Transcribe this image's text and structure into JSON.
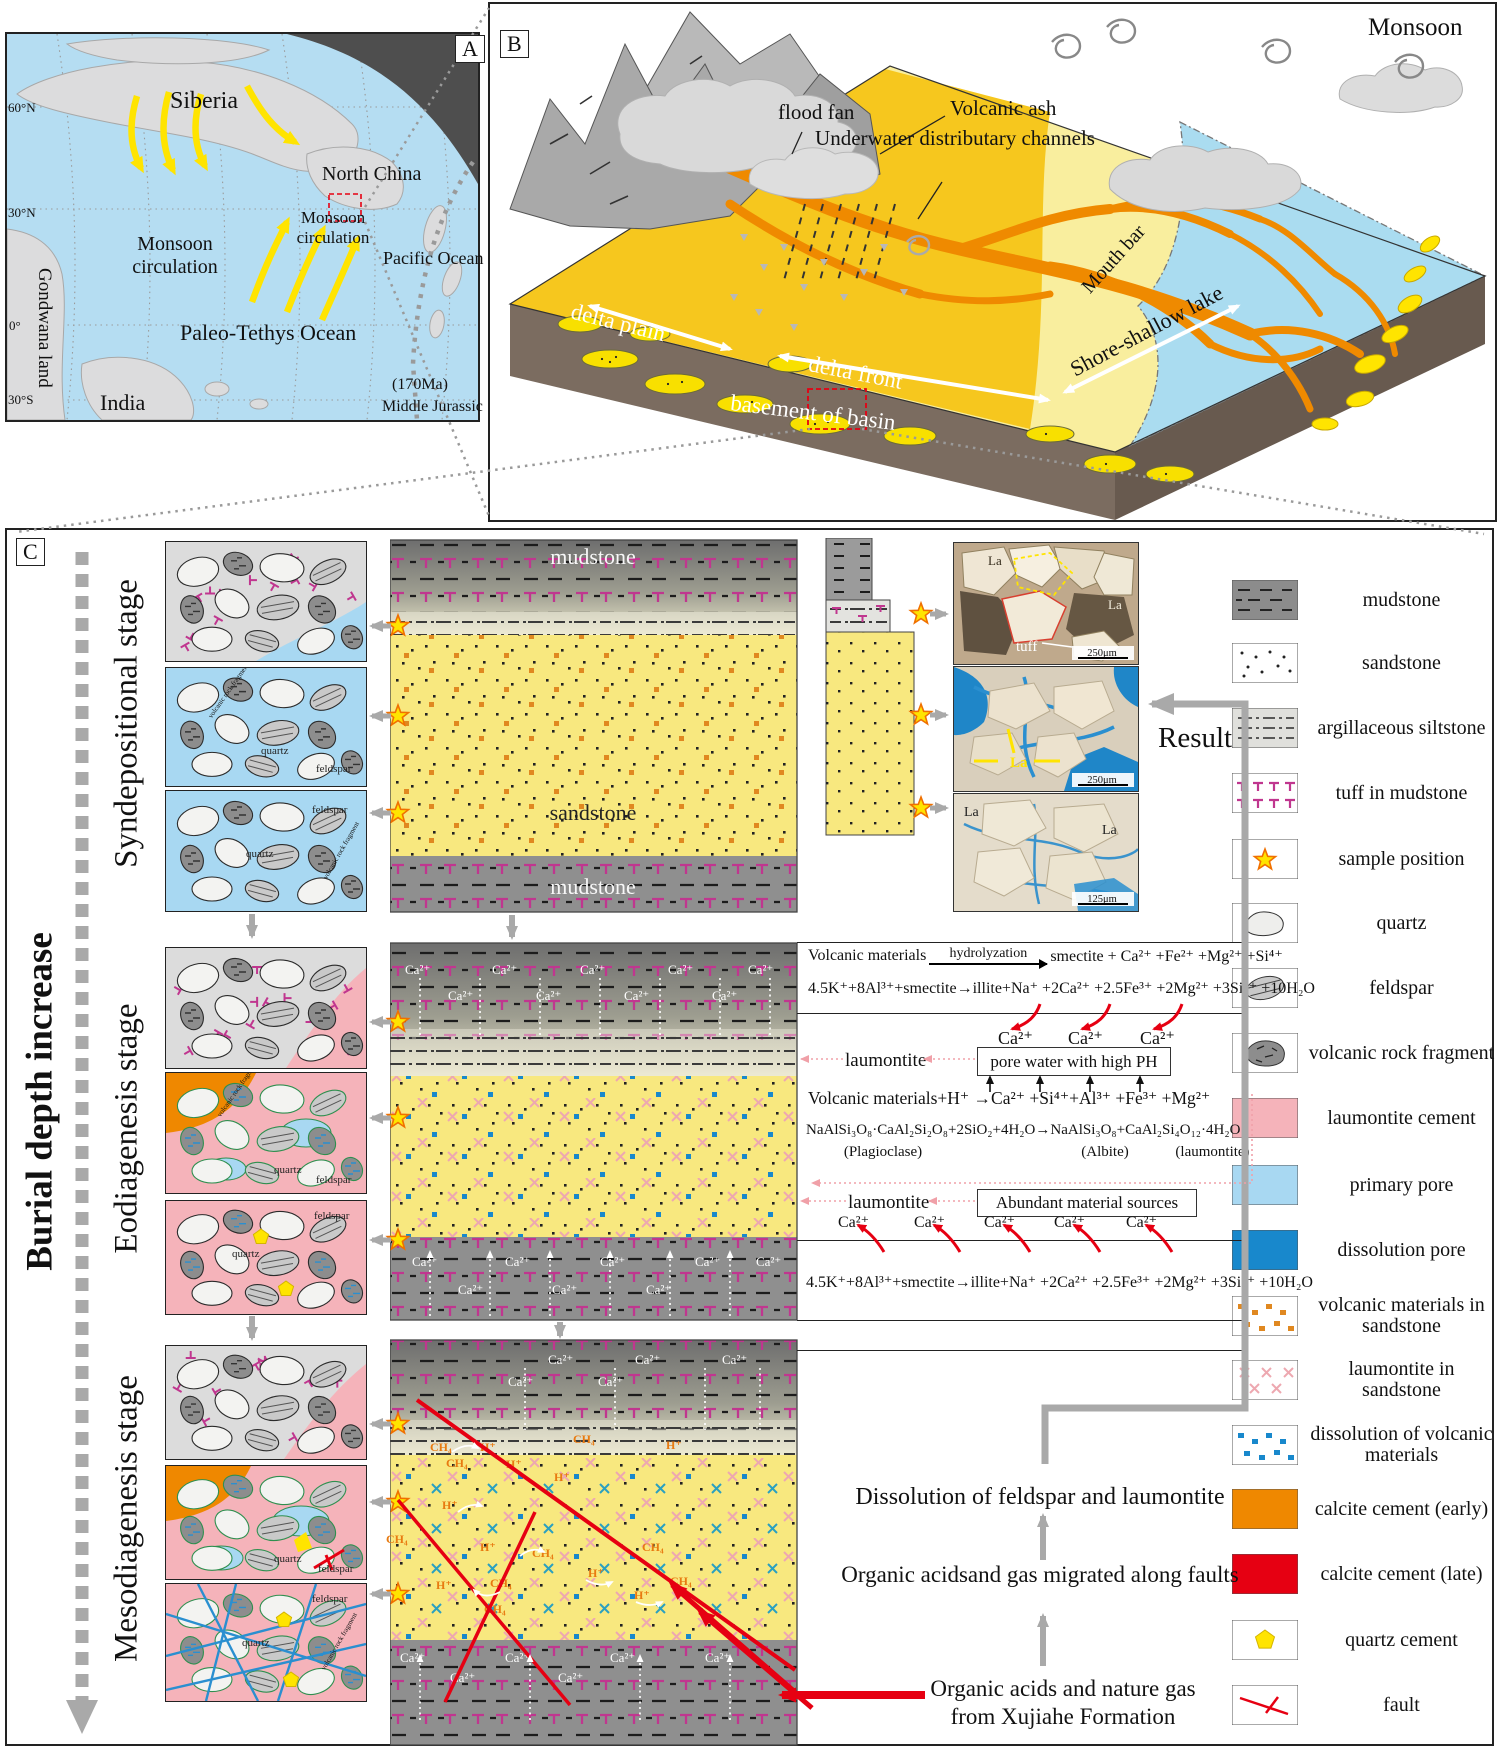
{
  "panel_a": {
    "tag": "A",
    "siberia": "Siberia",
    "north_china": "North China",
    "monsoon_west": "Monsoon circulation",
    "monsoon_east": "Monsoon circulation",
    "pacific": "Pacific Ocean",
    "paleo_tethys": "Paleo-Tethys Ocean",
    "gondwana": "Gondwana land",
    "india": "India",
    "lat_60n": "60°N",
    "lat_30n": "30°N",
    "lat_0": "0°",
    "lat_30s": "30°S",
    "age": "(170Ma)",
    "period": "Middle Jurassic"
  },
  "panel_b": {
    "tag": "B",
    "monsoon": "Monsoon",
    "flood_fan": "flood fan",
    "volcanic_ash": "Volcanic ash",
    "channels": "Underwater distributary channels",
    "mouth_bar": "Mouth bar",
    "shore_lake": "Shore-shallow lake",
    "delta_plain": "delta plain",
    "delta_front": "delta front",
    "basement": "basement of basin"
  },
  "panel_c": {
    "tag": "C",
    "burial_axis": "Burial depth increase",
    "stage_syn": "Syndepositional stage",
    "stage_eo": "Eodiagenesis stage",
    "stage_meso": "Mesodiagenesis stage",
    "mudstone_top": "mudstone",
    "sandstone": "sandstone",
    "mudstone_bottom": "mudstone",
    "grain_quartz": "quartz",
    "grain_feldspar": "feldspar",
    "grain_vrf": "volcanic rock fragment",
    "la": "La",
    "tuff": "tuff",
    "scale_250": "250μm",
    "scale_125": "125μm",
    "result": "Result",
    "ca": "Ca²⁺",
    "ch4": "CH₄",
    "h": "H⁺",
    "eq_hydro_left": "Volcanic materials",
    "eq_hydro_top": "hydrolyzation",
    "eq_hydro_right": "smectite + Ca²⁺ +Fe²⁺ +Mg²⁺ +Si⁴⁺",
    "eq_illite": "4.5K⁺+8Al³⁺+smectite→illite+Na⁺ +2Ca²⁺ +2.5Fe³⁺ +2Mg²⁺ +3Si⁴⁺ +10H₂O",
    "laumontite": "laumontite",
    "pore_water_box": "pore water with high PH",
    "eq_volcanic_h": "Volcanic materials+H⁺ →Ca²⁺ +Si⁴⁺+Al³⁺ +Fe³⁺ +Mg²⁺",
    "eq_plagioclase": "NaAlSi₃O₈·CaAl₂Si₂O₈+2SiO₂+4H₂O→NaAlSi₃O₈+CaAl₂Si₄O₁₂·4H₂O",
    "lbl_plagioclase": "(Plagioclase)",
    "lbl_albite": "(Albite)",
    "lbl_laumontite": "(laumontite)",
    "abundant_box": "Abundant material sources",
    "txt_dissolution": "Dissolution of feldspar and laumontite",
    "txt_migration": "Organic acidsand gas migrated along faults",
    "txt_organic1": "Organic acids and nature gas",
    "txt_organic2": "from Xujiahe Formation"
  },
  "legend": {
    "items": [
      {
        "key": "mudstone",
        "label": "mudstone"
      },
      {
        "key": "sandstone",
        "label": "sandstone"
      },
      {
        "key": "argillaceous-siltstone",
        "label": "argillaceous siltstone"
      },
      {
        "key": "tuff-in-mudstone",
        "label": "tuff in mudstone"
      },
      {
        "key": "sample-position",
        "label": "sample position"
      },
      {
        "key": "quartz",
        "label": "quartz"
      },
      {
        "key": "feldspar",
        "label": "feldspar"
      },
      {
        "key": "volcanic-rock-fragment",
        "label": "volcanic rock fragment"
      },
      {
        "key": "laumontite-cement",
        "label": "laumontite cement"
      },
      {
        "key": "primary-pore",
        "label": "primary pore"
      },
      {
        "key": "dissolution-pore",
        "label": "dissolution pore"
      },
      {
        "key": "volcanic-materials-in-sandstone",
        "label": "volcanic materials in sandstone"
      },
      {
        "key": "laumontite-in-sandstone",
        "label": "laumontite in sandstone"
      },
      {
        "key": "dissolution-of-volcanic-materials",
        "label": "dissolution of volcanic materials"
      },
      {
        "key": "calcite-cement-early",
        "label": "calcite cement (early)"
      },
      {
        "key": "calcite-cement-late",
        "label": "calcite cement (late)"
      },
      {
        "key": "quartz-cement",
        "label": "quartz cement"
      },
      {
        "key": "fault",
        "label": "fault"
      }
    ]
  },
  "colors": {
    "ocean": "#b5ddf2",
    "land": "#dcdcdd",
    "arrow_yellow": "#ffe400",
    "mudstone": "#8f8f8f",
    "tuff_pink": "#c0368f",
    "sand_yellow": "#f8e87f",
    "laumontite_pink": "#f5b3ba",
    "primary_pore": "#a8d8f2",
    "dissolution_pore": "#1888cc",
    "volcanic_orange": "#e08820",
    "calcite_early": "#ef8800",
    "calcite_late": "#e60012",
    "quartz_cement": "#ffe400",
    "channel_orange": "#ef8a00",
    "delta_plain": "#f6c71e",
    "delta_front": "#f9ee9e",
    "lake": "#aadcf0",
    "basement": "#7b6c60",
    "fault_red": "#e60012"
  }
}
